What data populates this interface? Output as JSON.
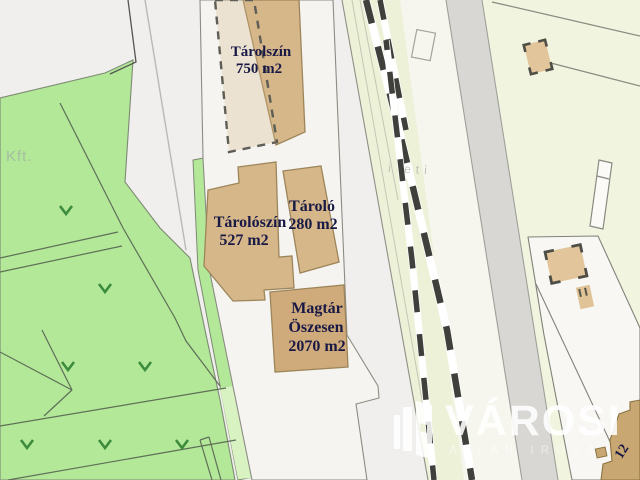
{
  "map": {
    "area_label": "Kft.",
    "faint_label": "i eti",
    "buildings": [
      {
        "name": "Tárolszín",
        "area": "750 m2"
      },
      {
        "name": "Tárolószín",
        "area": "527 m2"
      },
      {
        "name": "Tároló",
        "area": "280 m2"
      },
      {
        "name": "Magtár",
        "qualifier": "Öszesen",
        "area": "2070 m2"
      }
    ],
    "house_number": "12"
  },
  "watermark": {
    "brand": "VÁROSI",
    "subtitle": "ATLAN IRODA"
  },
  "colors": {
    "background": "#f0efed",
    "parcel_green": "#b2e897",
    "parcel_green_light": "#d8f2c2",
    "vegetation_marker": "#3d8b3d",
    "building_tan": "#d6b78a",
    "building_tan_dark": "#c9a772",
    "label_navy": "#191945",
    "railway_corridor": "#edf1d8",
    "road_gray": "#d8d7d4",
    "pale_parcel": "#f1f4df"
  }
}
